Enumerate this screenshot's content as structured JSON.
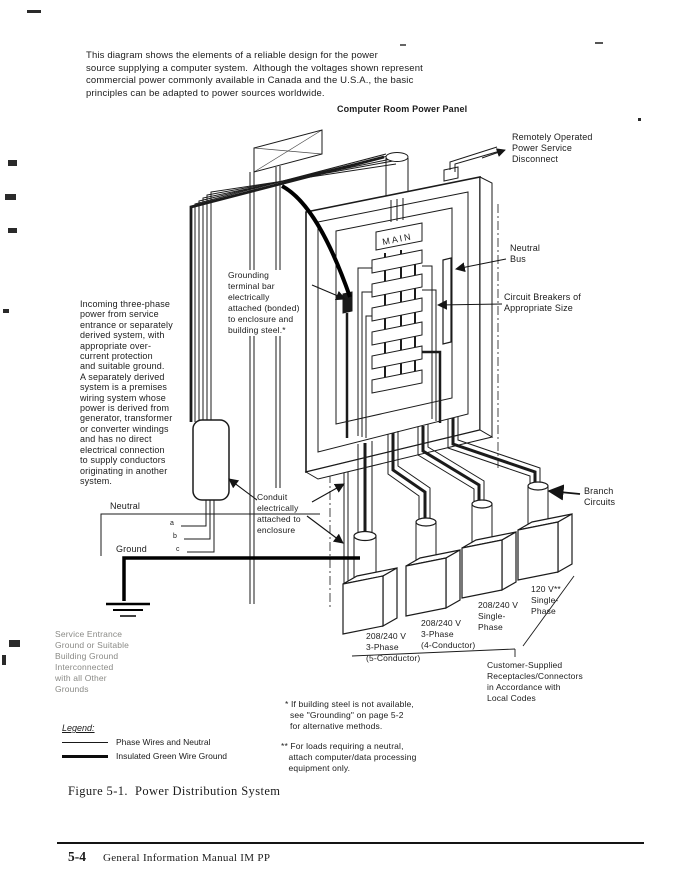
{
  "document": {
    "intro": "This diagram shows the elements of a reliable design for the power\nsource supplying a computer system.  Although the voltages shown represent\ncommercial power commonly available in Canada and the U.S.A., the basic\nprinciples can be adapted to power sources worldwide.",
    "diagram_title": "Computer Room Power Panel",
    "figure_caption": "Figure 5-1.  Power Distribution System",
    "page_number": "5-4",
    "manual_title": "General Information Manual IM PP"
  },
  "diagram": {
    "ink_color": "#1b1b1b",
    "paper_color": "#ffffff",
    "labels": {
      "incoming_power": "Incoming three-phase\npower from service\nentrance or separately\nderived system, with\nappropriate over-\ncurrent protection\nand suitable ground.\nA separately derived\nsystem is a premises\nwiring system whose\npower is derived from\ngenerator, transformer\nor converter windings\nand has no direct\nelectrical connection\nto supply conductors\noriginating in another\nsystem.",
      "grounding_terminal_bar": "Grounding\nterminal bar\nelectrically\nattached (bonded)\nto enclosure and\nbuilding steel.*",
      "remote_disconnect": "Remotely Operated\nPower Service\nDisconnect",
      "neutral_bus": "Neutral\nBus",
      "circuit_breakers": "Circuit Breakers of\nAppropriate Size",
      "conduit": "Conduit\nelectrically\nattached to\nenclosure",
      "branch_circuits": "Branch\nCircuits",
      "neutral": "Neutral",
      "ground": "Ground",
      "main_breaker": "MAIN",
      "phase_a": "a",
      "phase_b": "b",
      "phase_c": "c",
      "service_entrance_ground": "Service Entrance\nGround or Suitable\nBuilding Ground\nInterconnected\nwith all Other\nGrounds",
      "outlet_1": "208/240 V\n3-Phase\n(5-Conductor)",
      "outlet_2": "208/240 V\n3-Phase\n(4-Conductor)",
      "outlet_3": "208/240 V\nSingle-\nPhase",
      "outlet_4": "120 V**\nSingle-\nPhase",
      "customer_receptacles": "Customer-Supplied\nReceptacles/Connectors\nin Accordance with\nLocal Codes"
    },
    "footnotes": {
      "building_steel": "* If building steel is not available,\n  see \"Grounding\" on page 5-2\n  for alternative methods.",
      "neutral_loads": "** For loads requiring a neutral,\n   attach computer/data processing\n   equipment only."
    },
    "legend": {
      "title": "Legend:",
      "phase_wires": "Phase Wires and Neutral",
      "ground_wire": "Insulated Green Wire Ground"
    }
  }
}
